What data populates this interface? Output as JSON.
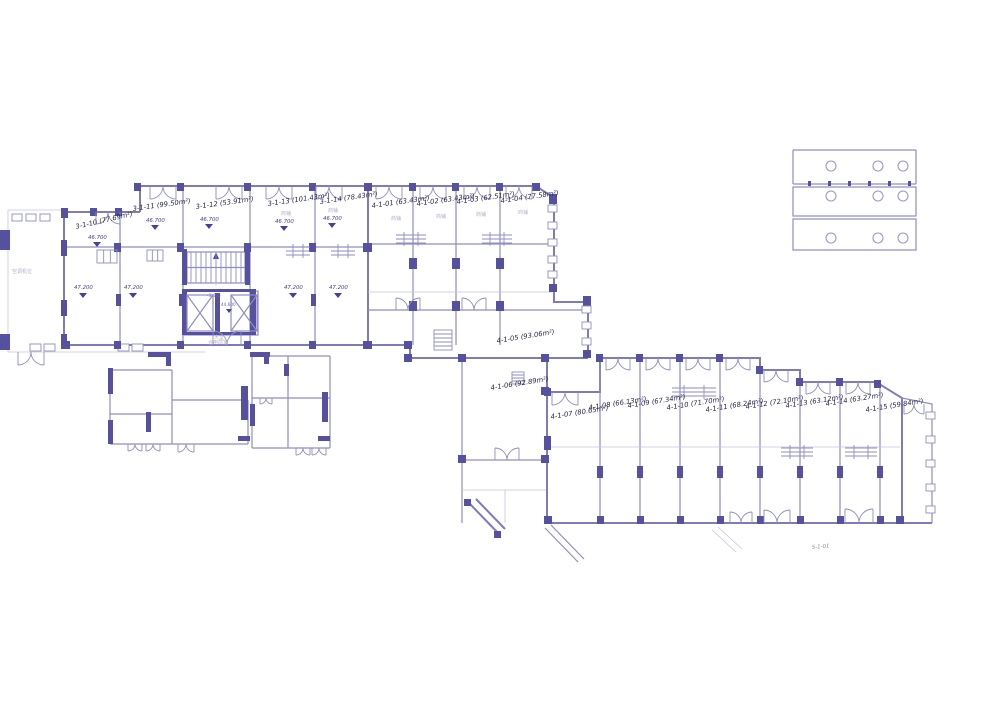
{
  "palette": {
    "wall_fill": "#55509f",
    "wall_line": "#7e7bb8",
    "partition_line": "#8f8dc5",
    "light_line": "#c5c4e0",
    "label_text": "#26264d",
    "elevation_text": "#4340a0",
    "muted_text": "#b2b1c8",
    "background": "#ffffff"
  },
  "labels": {
    "u3_10": "3-1-10 (77.69m²)",
    "u3_11": "3-1-11 (99.50m²)",
    "u3_12": "3-1-12 (53.91m²)",
    "u3_13": "3-1-13 (101.43m²)",
    "u3_14": "3-1-14 (78.43m²)",
    "u4_01": "4-1-01 (63.43m²)",
    "u4_02": "4-1-02 (63.43m²)",
    "u4_03": "4-1-03 (62.51m²)",
    "u4_04": "4-1-04 (77.58m²)",
    "u4_05": "4-1-05 (93.06m²)",
    "u4_06": "4-1-06 (92.89m²)",
    "u4_07": "4-1-07 (80.65m²)",
    "u4_08": "4-1-08 (66.13m²)",
    "u4_09": "4-1-09 (67.34m²)",
    "u4_10": "4-1-10 (71.70m²)",
    "u4_11": "4-1-11 (68.24m²)",
    "u4_12": "4-1-12 (72.10m²)",
    "u4_13": "4-1-13 (63.12m²)",
    "u4_14": "4-1-14 (63.27m²)",
    "u4_15": "4-1-15 (59.84m²)",
    "u5_01": "5-1-01"
  },
  "levels": {
    "l467": "46.700",
    "l472": "47.200",
    "l446": "44.600",
    "l345": "-3.450"
  },
  "annotations": {
    "shop": "商铺",
    "lobby": "大堂",
    "vestibule": "合用前室",
    "ac": "空调机位"
  }
}
